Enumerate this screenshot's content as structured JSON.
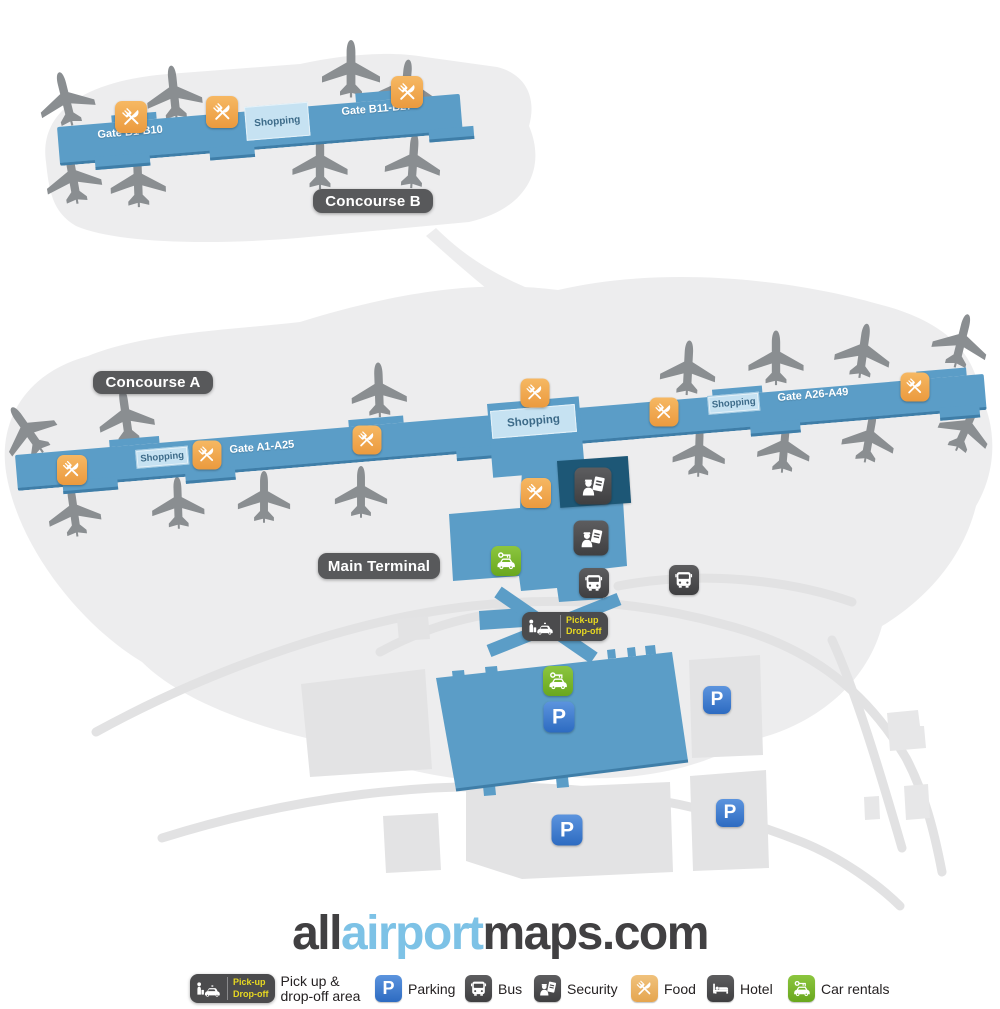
{
  "colors": {
    "concourse_blue": "#5b9dc7",
    "concourse_edge": "#3f7ea8",
    "shopping_blue": "#c6e2f2",
    "background_blob": "#ededee",
    "road_gray": "#e2e2e3",
    "plane_gray": "#8a8e91",
    "label_gray": "#58595b",
    "food_orange": "#ec9c40",
    "security_navy": "#1d5776",
    "icon_dark": "#4a4a4c",
    "rental_green": "#76b82a",
    "parking_blue": "#3e7dc9",
    "pickup_yellow": "#e8d921",
    "logo_dark": "#414042",
    "logo_blue": "#7dc2e6"
  },
  "map": {
    "concourse_b": {
      "label": "Concourse B",
      "gate_left": "Gate B1-B10",
      "shopping": "Shopping",
      "gate_right": "Gate B11-B27"
    },
    "concourse_a": {
      "label": "Concourse A",
      "gate_left": "Gate A1-A25",
      "gate_right": "Gate A26-A49",
      "shopping_left": "Shopping",
      "shopping_center": "Shopping",
      "shopping_right": "Shopping"
    },
    "main_terminal_label": "Main Terminal",
    "pickup_badge": {
      "line1": "Pick-up",
      "line2": "Drop-off"
    },
    "parking_letter": "P"
  },
  "logo": {
    "all": "all",
    "airport": "airport",
    "maps": "maps.com"
  },
  "legend": {
    "pickup_badge": {
      "line1": "Pick-up",
      "line2": "Drop-off"
    },
    "pickup_label_line1": "Pick up &",
    "pickup_label_line2": "drop-off area",
    "parking": "Parking",
    "bus": "Bus",
    "security": "Security",
    "food": "Food",
    "hotel": "Hotel",
    "car_rentals": "Car rentals"
  }
}
